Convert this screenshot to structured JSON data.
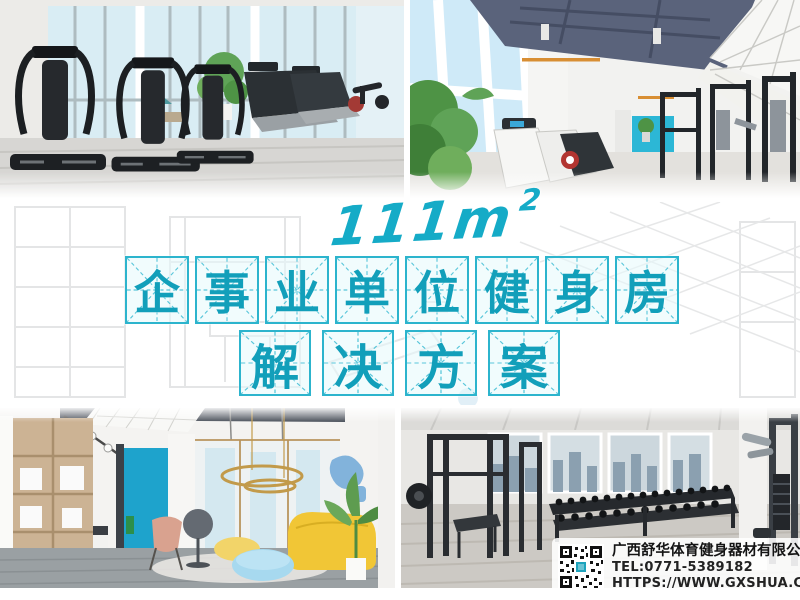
{
  "headline": {
    "area": "111m",
    "area_exponent": "2"
  },
  "title": {
    "line1": {
      "text": "企事业单位健身房",
      "chars": [
        "企",
        "事",
        "业",
        "单",
        "位",
        "健",
        "身",
        "房"
      ]
    },
    "line2": {
      "text": "解决方案",
      "chars": [
        "解",
        "决",
        "方",
        "案"
      ]
    }
  },
  "contact": {
    "company": "广西舒华体育健身器材有限公司",
    "tel": "TEL:0771-5389182",
    "website": "HTTPS://WWW.GXSHUA.COM"
  },
  "photos": {
    "top_left": "cardio-equipment-room",
    "top_right": "strength-gym-blue-ceiling",
    "bottom_left": "lounge-reception-area",
    "bottom_right": "free-weights-room",
    "middle": "faded-gym-background"
  },
  "colors": {
    "accent_cyan": "#15abc7",
    "box_border": "#2cb4cd",
    "char_color": "#129fba",
    "text_dark": "#141414"
  }
}
